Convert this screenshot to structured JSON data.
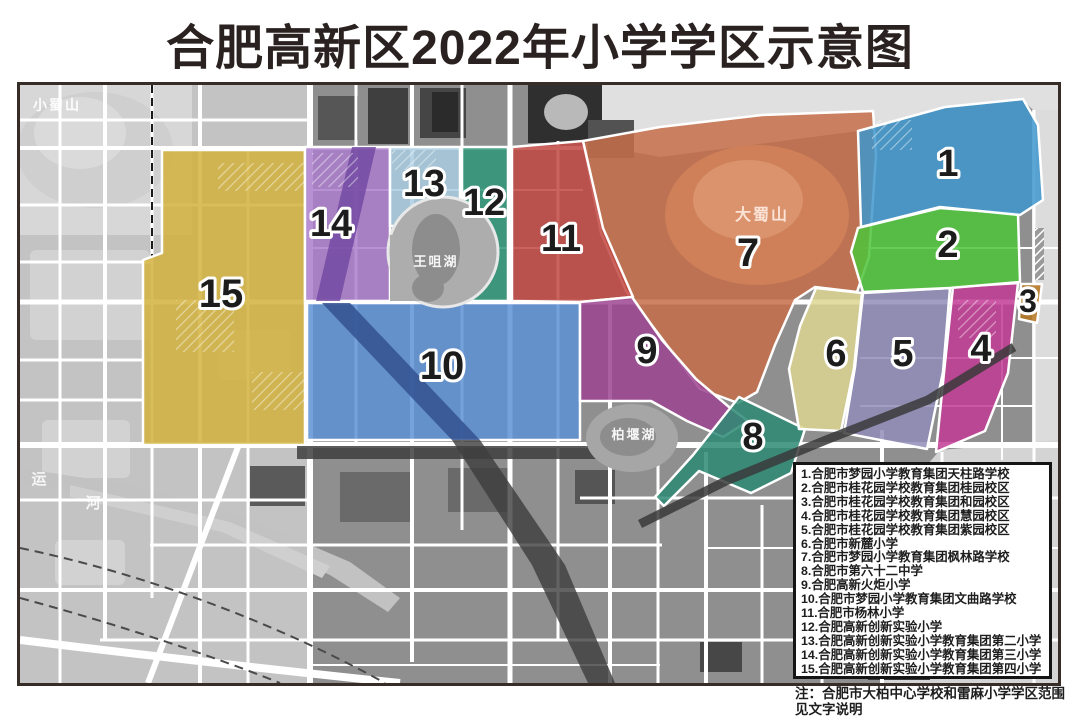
{
  "title": "合肥高新区2022年小学学区示意图",
  "legend": {
    "items": [
      "1.合肥市梦园小学教育集团天柱路学校",
      "2.合肥市桂花园学校教育集团桂园校区",
      "3.合肥市桂花园学校教育集团和园校区",
      "4.合肥市桂花园学校教育集团慧园校区",
      "5.合肥市桂花园学校教育集团紫园校区",
      "6.合肥市新麓小学",
      "7.合肥市梦园小学教育集团枫林路学校",
      "8.合肥市第六十二中学",
      "9.合肥高新火炬小学",
      "10.合肥市梦园小学教育集团文曲路学校",
      "11.合肥市杨林小学",
      "12.合肥高新创新实验小学",
      "13.合肥高新创新实验小学教育集团第二小学",
      "14.合肥高新创新实验小学教育集团第三小学",
      "15.合肥高新创新实验小学教育集团第四小学"
    ]
  },
  "note": {
    "line1": "注：合肥市大柏中心学校和雷麻小学学区范围",
    "line2": "见文字说明"
  },
  "colors": {
    "map_border": "#362c28",
    "base_gray": "#8f8f8f",
    "left_light_gray": "#c3c3c3",
    "top_right_light": "#e0e0e0",
    "road_white": "#ffffff",
    "label_ink": "#1c1c1c"
  },
  "map": {
    "regions": [
      {
        "id": 7,
        "label": "7",
        "color": "#c66f49",
        "label_pos": [
          748,
          266
        ],
        "font": 40,
        "points": "583,141 660,127 762,115 873,111 876,155 869,257 857,292 815,287 795,300 775,345 757,392 738,403 700,389 663,340 626,291 601,233"
      },
      {
        "id": 15,
        "label": "15",
        "color": "#d2b13d",
        "label_pos": [
          221,
          307
        ],
        "font": 40,
        "points": "162,150 305,150 305,445 143,445 143,260 162,253"
      },
      {
        "id": 14,
        "label": "14",
        "color": "#ab7ecd",
        "label_pos": [
          331,
          236
        ],
        "font": 38,
        "points": "305,147 390,147 390,301 305,301"
      },
      {
        "id": 13,
        "label": "13",
        "color": "#a9cde0",
        "label_pos": [
          424,
          196
        ],
        "font": 38,
        "points": "390,147 460,147 460,226 390,226"
      },
      {
        "id": 12,
        "label": "12",
        "color": "#2f9778",
        "label_pos": [
          484,
          215
        ],
        "font": 38,
        "points": "462,147 508,147 508,301 462,301"
      },
      {
        "id": 11,
        "label": "11",
        "color": "#c14742",
        "label_pos": [
          561,
          251
        ],
        "font": 38,
        "points": "512,147 583,141 603,228 633,297 580,302 512,301"
      },
      {
        "id": 10,
        "label": "10",
        "color": "#5e92d6",
        "label_pos": [
          442,
          379
        ],
        "font": 40,
        "points": "307,303 580,303 580,440 307,440"
      },
      {
        "id": 9,
        "label": "9",
        "color": "#9c4492",
        "label_pos": [
          647,
          363
        ],
        "font": 38,
        "points": "580,302 632,297 662,340 696,379 729,407 748,421 723,437 687,421 651,401 580,401"
      },
      {
        "id": 8,
        "label": "8",
        "color": "#2d8a74",
        "label_pos": [
          753,
          449
        ],
        "font": 38,
        "points": "739,397 805,429 791,473 751,493 699,471 664,506 655,497 693,455 712,431"
      },
      {
        "id": 6,
        "label": "6",
        "color": "#ddd692",
        "label_pos": [
          836,
          366
        ],
        "font": 38,
        "points": "816,288 862,293 854,368 841,431 799,429 789,369 800,326"
      },
      {
        "id": 5,
        "label": "5",
        "color": "#918cb8",
        "label_pos": [
          903,
          366
        ],
        "font": 38,
        "points": "863,293 950,288 943,372 927,449 844,433 855,367"
      },
      {
        "id": 4,
        "label": "4",
        "color": "#c23b94",
        "label_pos": [
          981,
          361
        ],
        "font": 38,
        "points": "953,287 1018,283 1008,373 985,431 936,452 945,363"
      },
      {
        "id": 3,
        "label": "3",
        "color": "#b5741f",
        "label_pos": [
          1028,
          312
        ],
        "font": 32,
        "points": "1021,284 1042,284 1037,323 1019,319"
      },
      {
        "id": 2,
        "label": "2",
        "color": "#4ec43a",
        "label_pos": [
          948,
          257
        ],
        "font": 38,
        "points": "858,228 940,208 1018,214 1020,282 950,288 863,292 851,252"
      },
      {
        "id": 1,
        "label": "1",
        "color": "#3e96cc",
        "label_pos": [
          948,
          176
        ],
        "font": 38,
        "points": "858,131 945,107 1023,99 1038,125 1043,200 1020,215 940,207 861,227"
      }
    ],
    "places": [
      {
        "id": "xiaoshushan",
        "name": "小蜀山",
        "pos": [
          33,
          110
        ],
        "size": 14,
        "color": "rgba(255,255,255,0.92)",
        "anchor": "start"
      },
      {
        "id": "wangzuihu",
        "name": "王咀湖",
        "pos": [
          436,
          266
        ],
        "size": 13,
        "color": "rgba(255,255,255,0.92)",
        "anchor": "middle"
      },
      {
        "id": "dashushan",
        "name": "大蜀山",
        "pos": [
          762,
          220
        ],
        "size": 16,
        "color": "rgba(255,236,226,0.9)",
        "anchor": "middle"
      },
      {
        "id": "baiyanhu",
        "name": "柏堰湖",
        "pos": [
          634,
          439
        ],
        "size": 13,
        "color": "rgba(255,255,255,0.92)",
        "anchor": "middle"
      },
      {
        "id": "yunhe-yun",
        "name": "运",
        "pos": [
          40,
          484
        ],
        "size": 15,
        "color": "rgba(255,255,255,0.85)",
        "anchor": "middle"
      },
      {
        "id": "yunhe-he",
        "name": "河",
        "pos": [
          94,
          508
        ],
        "size": 15,
        "color": "rgba(255,255,255,0.85)",
        "anchor": "middle"
      }
    ]
  }
}
